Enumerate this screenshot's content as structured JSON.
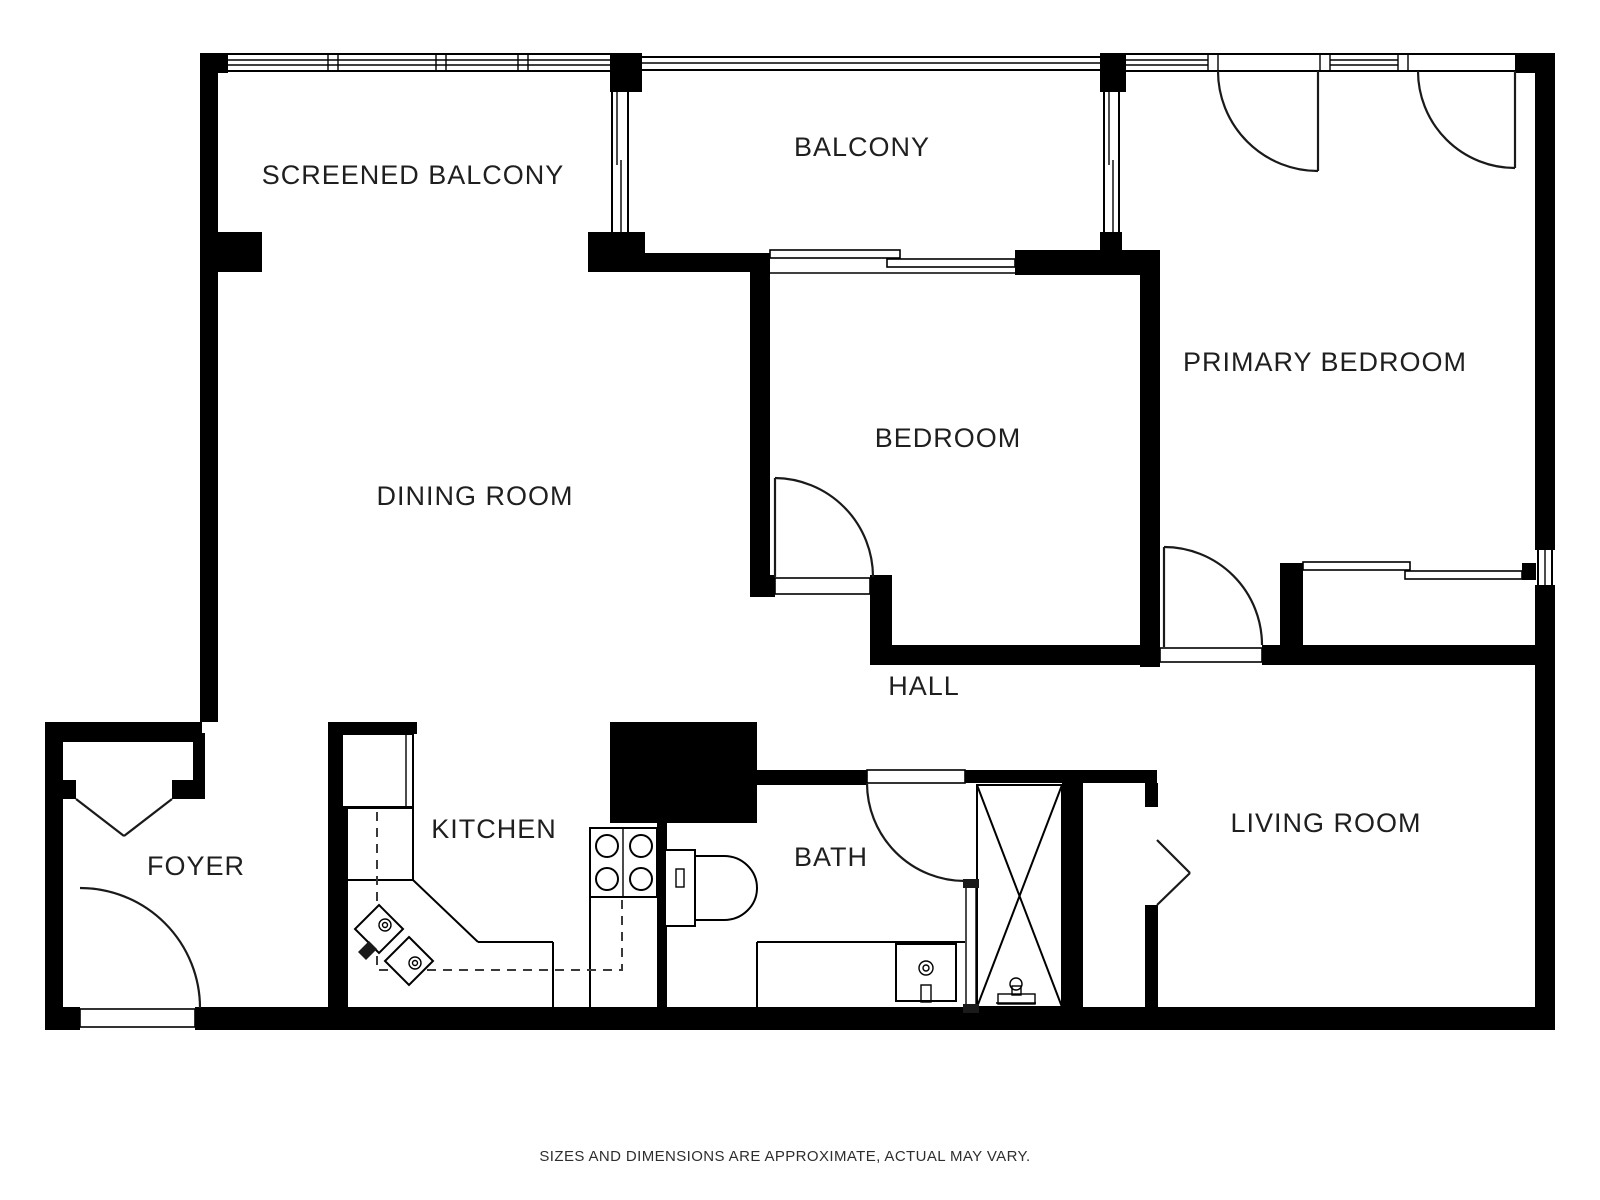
{
  "page": {
    "type": "floor-plan",
    "background": "#ffffff",
    "wall_color": "#000000",
    "label_color": "#1f1f1f"
  },
  "floor_plan": {
    "rooms": [
      {
        "id": "screened-balcony",
        "label": "SCREENED BALCONY"
      },
      {
        "id": "balcony",
        "label": "BALCONY"
      },
      {
        "id": "primary-bedroom",
        "label": "PRIMARY BEDROOM"
      },
      {
        "id": "dining-room",
        "label": "DINING ROOM"
      },
      {
        "id": "bedroom",
        "label": "BEDROOM"
      },
      {
        "id": "hall",
        "label": "HALL"
      },
      {
        "id": "foyer",
        "label": "FOYER"
      },
      {
        "id": "kitchen",
        "label": "KITCHEN"
      },
      {
        "id": "bath",
        "label": "BATH"
      },
      {
        "id": "living-room",
        "label": "LIVING ROOM"
      }
    ],
    "fixtures": [
      "refrigerator",
      "kitchen-corner-sink",
      "stove-4-burner",
      "toilet",
      "vanity-sink",
      "shower-enclosure",
      "entry-double-doors",
      "entry-door",
      "bifold-closet-door",
      "sliding-closet-doors",
      "sliding-balcony-door"
    ],
    "disclaimer": "SIZES AND DIMENSIONS ARE APPROXIMATE, ACTUAL MAY VARY."
  }
}
